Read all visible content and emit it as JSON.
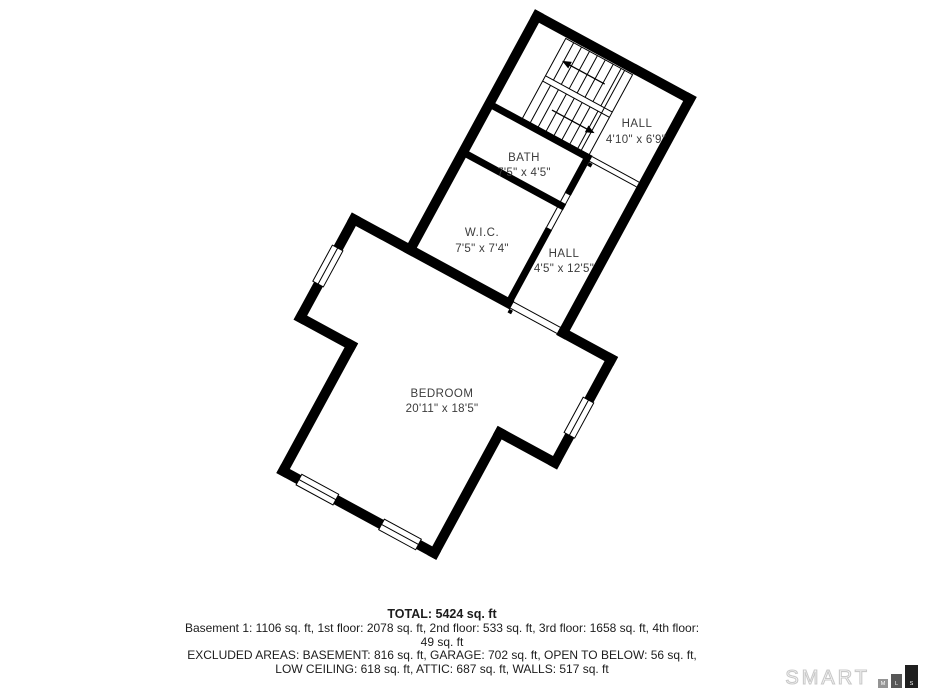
{
  "plan": {
    "rooms": [
      {
        "name": "HALL",
        "dims": "4'10\" x 6'9\""
      },
      {
        "name": "BATH",
        "dims": "7'5\" x 4'5\""
      },
      {
        "name": "W.I.C.",
        "dims": "7'5\" x 7'4\""
      },
      {
        "name": "HALL",
        "dims": "4'5\" x 12'5\""
      },
      {
        "name": "BEDROOM",
        "dims": "20'11\" x 18'5\""
      }
    ]
  },
  "summary": {
    "total": "TOTAL: 5424 sq. ft",
    "floors": "Basement 1: 1106 sq. ft, 1st floor: 2078 sq. ft, 2nd floor: 533 sq. ft, 3rd floor: 1658 sq. ft, 4th floor: 49 sq. ft",
    "excluded_line1": "EXCLUDED AREAS: BASEMENT: 816 sq. ft, GARAGE: 702 sq. ft, OPEN TO BELOW: 56 sq. ft,",
    "excluded_line2": "LOW CEILING: 618 sq. ft, ATTIC: 687 sq. ft, WALLS: 517 sq. ft"
  },
  "logo": {
    "brand": "SMART",
    "block_m": "M",
    "block_l": "L",
    "block_s": "S"
  },
  "colors": {
    "wall": "#000000",
    "room_label": "#3c3c3c",
    "summary_text": "#1c1c1c",
    "logo_outline": "#c9c9c9",
    "logo_block_m": "#949494",
    "logo_block_l": "#575757",
    "logo_block_s": "#1f1f1f"
  }
}
